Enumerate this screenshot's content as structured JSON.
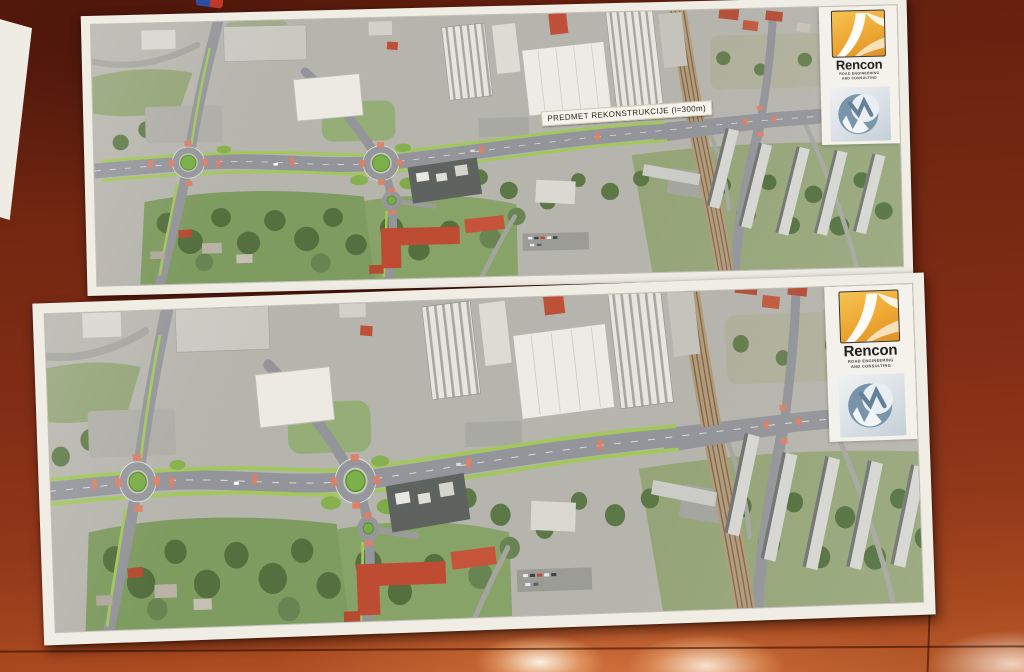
{
  "scene": {
    "description": "Photo of two printed aerial road-reconstruction plans lying on a glossy red-brown table",
    "table_color": "#7b2a14",
    "table_highlight_color": "#c4703d",
    "paper_color": "#f0ede5"
  },
  "prints": {
    "top": {
      "label": "PREDMET REKONSTRUKCIJE (l=300m)"
    },
    "bottom": {}
  },
  "logo": {
    "company": "Rencon",
    "tagline_line1": "ROAD ENGINEERING",
    "tagline_line2": "AND CONSULTING",
    "brand_orange": "#eda52c",
    "emblem_blue": "#72899e"
  },
  "map_colors": {
    "urban_base": "#b5b4ac",
    "vegetation": "#7e9b60",
    "road": "#94969a",
    "cycle_lane_green": "#a2c75a",
    "crossing_red": "#df7f68",
    "roundabout_island": "#79ad47",
    "railway": "#b29a7b",
    "red_roof": "#bd4c33"
  }
}
